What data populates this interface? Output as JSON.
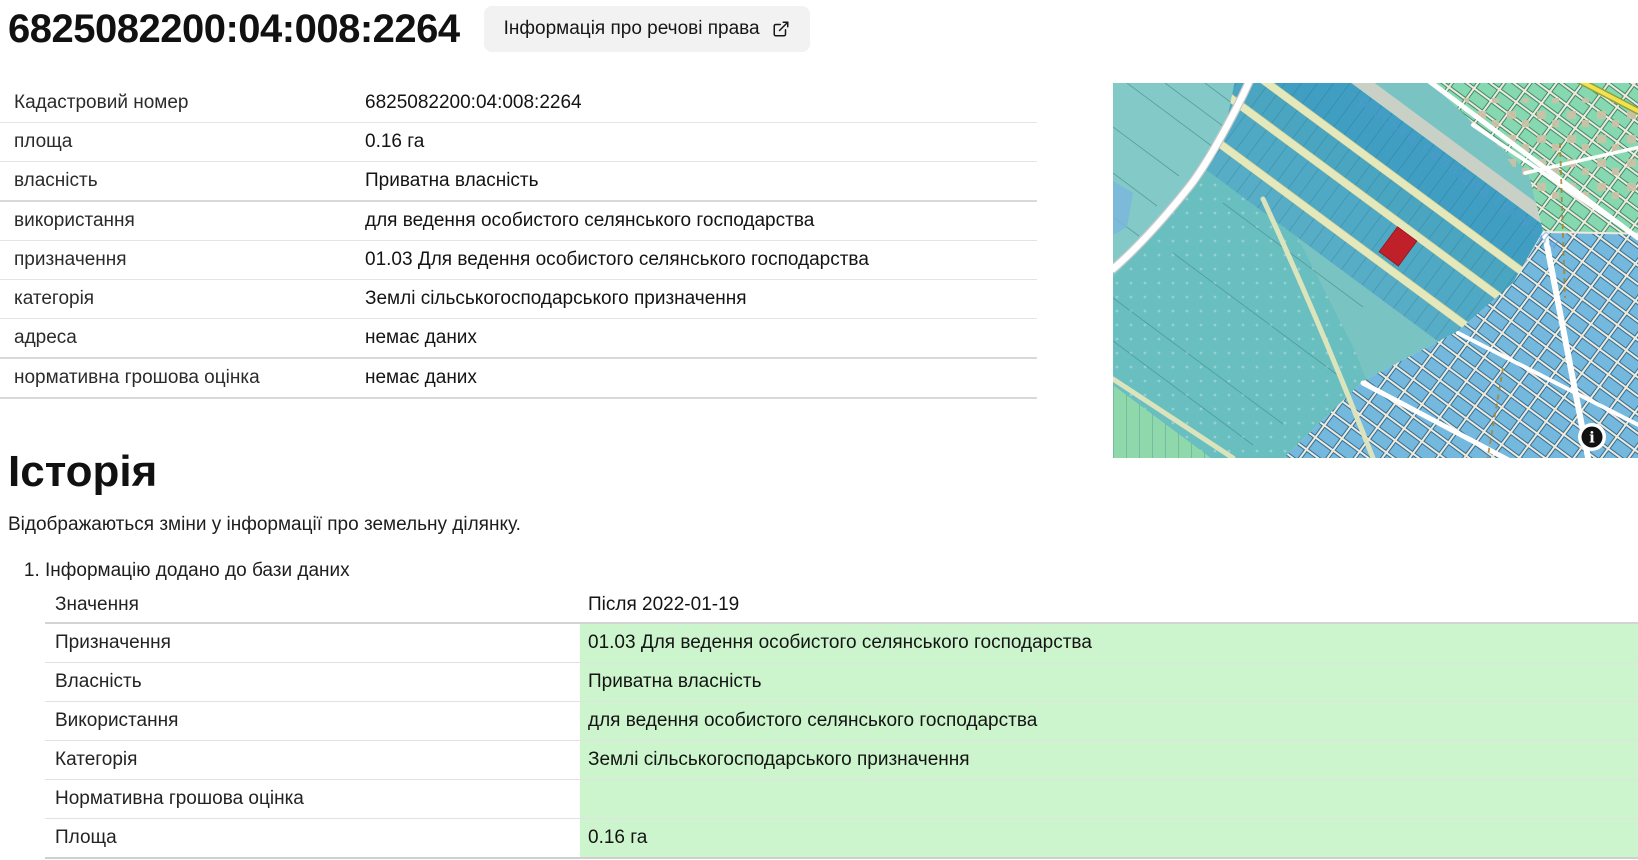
{
  "header": {
    "title": "6825082200:04:008:2264",
    "rights_button_label": "Інформація про речові права"
  },
  "details": {
    "rows": [
      {
        "label": "Кадастровий номер",
        "value": "6825082200:04:008:2264"
      },
      {
        "label": "площа",
        "value": "0.16 га"
      },
      {
        "label": "власність",
        "value": "Приватна власність"
      },
      {
        "label": "використання",
        "value": "для ведення особистого селянського господарства"
      },
      {
        "label": "призначення",
        "value": "01.03 Для ведення особистого селянського господарства"
      },
      {
        "label": "категорія",
        "value": "Землі сільськогосподарського призначення"
      },
      {
        "label": "адреса",
        "value": "немає даних"
      },
      {
        "label": "нормативна грошова оцінка",
        "value": "немає даних"
      }
    ]
  },
  "map": {
    "watermark": "рівська селищна громада",
    "info_icon_glyph": "i",
    "colors": {
      "highlight": "#cdf5cd",
      "btn-bg": "#f2f2f2",
      "parcel-red": "#c0202a",
      "map-teal": "#79c3c3",
      "map-dark-strip": "#3f9ec1",
      "watermark-blue": "#5b97d8"
    }
  },
  "history": {
    "heading": "Історія",
    "description": "Відображаються зміни у інформації про земельну ділянку.",
    "entries": [
      {
        "number": "1.",
        "title": "Інформацію додано до бази даних",
        "rows": [
          {
            "label": "Значення",
            "value": "Після 2022-01-19"
          },
          {
            "label": "Призначення",
            "value": "01.03 Для ведення особистого селянського господарства"
          },
          {
            "label": "Власність",
            "value": "Приватна власність"
          },
          {
            "label": "Використання",
            "value": "для ведення особистого селянського господарства"
          },
          {
            "label": "Категорія",
            "value": "Землі сільськогосподарського призначення"
          },
          {
            "label": "Нормативна грошова оцінка",
            "value": ""
          },
          {
            "label": "Площа",
            "value": "0.16 га"
          }
        ]
      }
    ]
  }
}
